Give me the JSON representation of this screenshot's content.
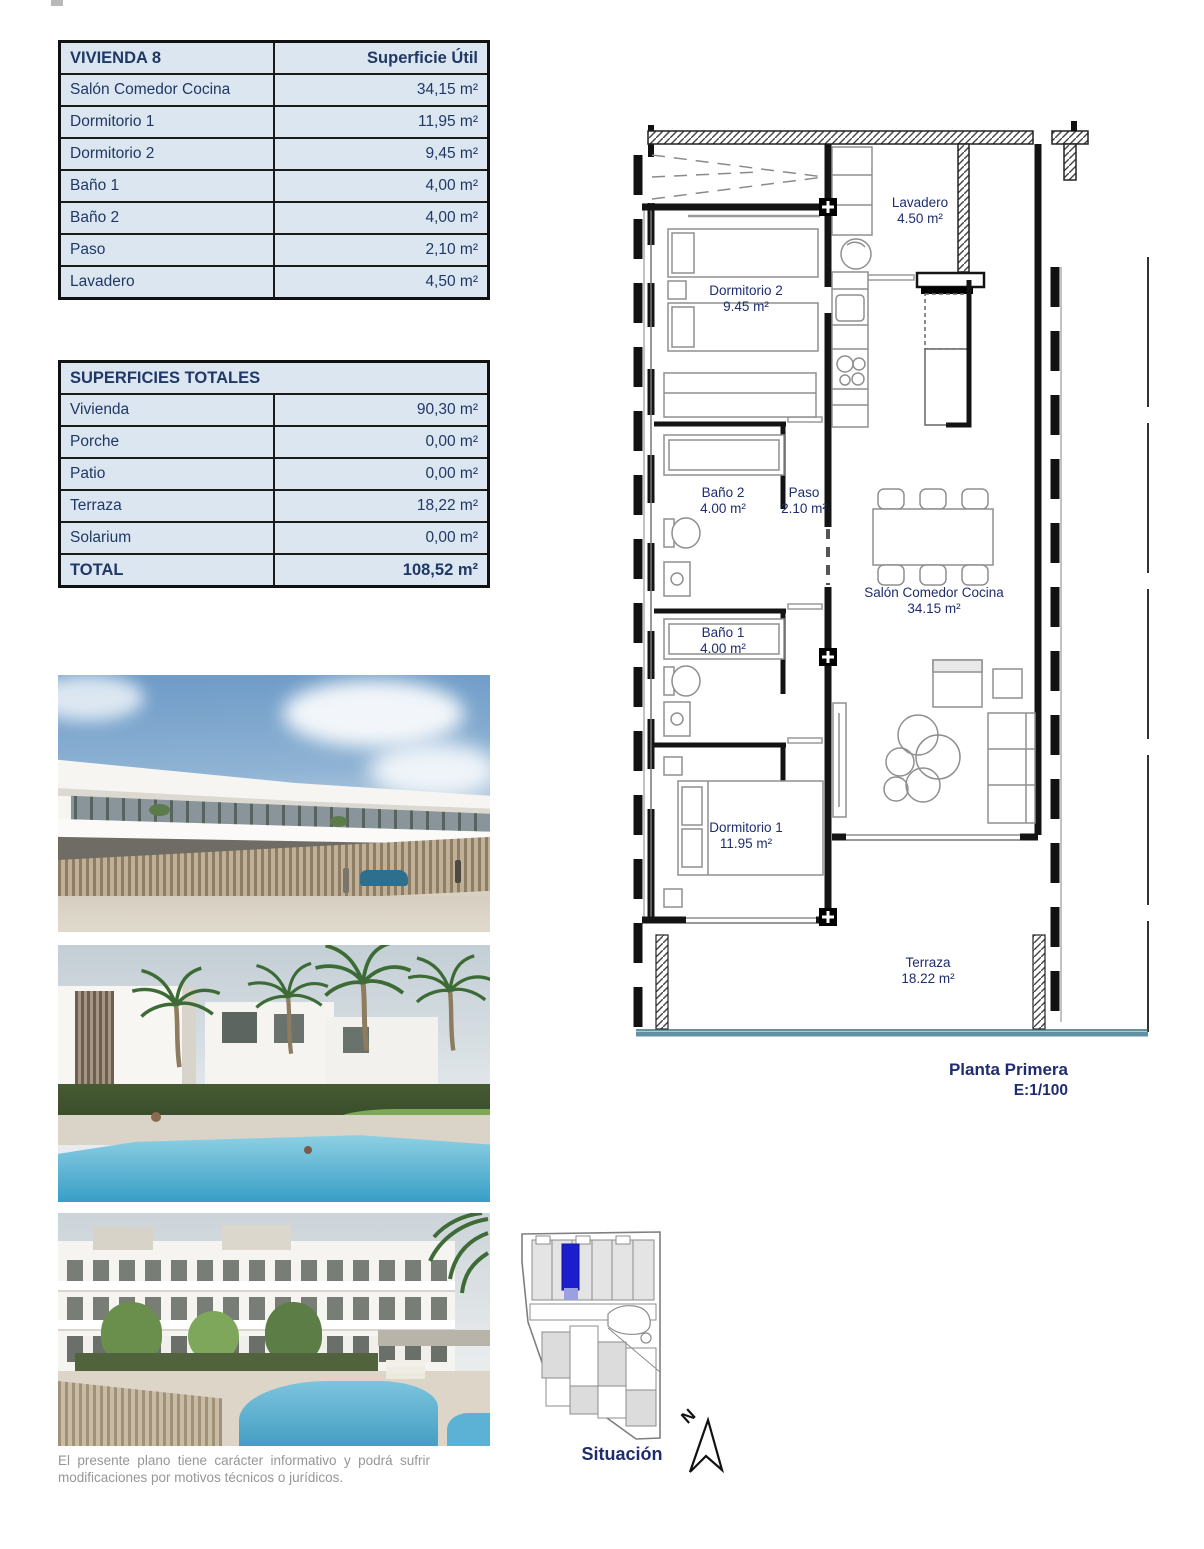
{
  "surface_table": {
    "title": "VIVIENDA 8",
    "header_right": "Superficie Útil",
    "rows": [
      {
        "label": "Salón Comedor Cocina",
        "value": "34,15 m²"
      },
      {
        "label": "Dormitorio 1",
        "value": "11,95 m²"
      },
      {
        "label": "Dormitorio 2",
        "value": "9,45 m²"
      },
      {
        "label": "Baño 1",
        "value": "4,00 m²"
      },
      {
        "label": "Baño 2",
        "value": "4,00 m²"
      },
      {
        "label": "Paso",
        "value": "2,10 m²"
      },
      {
        "label": "Lavadero",
        "value": "4,50 m²"
      }
    ]
  },
  "totals_table": {
    "title": "SUPERFICIES TOTALES",
    "rows": [
      {
        "label": "Vivienda",
        "value": "90,30 m²"
      },
      {
        "label": "Porche",
        "value": "0,00 m²"
      },
      {
        "label": "Patio",
        "value": "0,00 m²"
      },
      {
        "label": "Terraza",
        "value": "18,22 m²"
      },
      {
        "label": "Solarium",
        "value": "0,00 m²"
      }
    ],
    "total": {
      "label": "TOTAL",
      "value": "108,52 m²"
    }
  },
  "floor_plan": {
    "rooms": [
      {
        "name": "Lavadero",
        "area": "4.50 m²"
      },
      {
        "name": "Dormitorio 2",
        "area": "9.45 m²"
      },
      {
        "name": "Baño 2",
        "area": "4.00 m²"
      },
      {
        "name": "Paso",
        "area": "2.10 m²"
      },
      {
        "name": "Salón Comedor Cocina",
        "area": "34.15 m²"
      },
      {
        "name": "Baño 1",
        "area": "4.00 m²"
      },
      {
        "name": "Dormitorio 1",
        "area": "11.95 m²"
      },
      {
        "name": "Terraza",
        "area": "18.22 m²"
      }
    ],
    "caption": {
      "title": "Planta Primera",
      "scale": "E:1/100"
    }
  },
  "site_plan": {
    "label": "Situación",
    "north_label": "N"
  },
  "disclaimer": {
    "line1": "El presente plano tiene carácter informativo y podrá sufrir",
    "line2": "modificaciones por motivos técnicos o jurídicos."
  },
  "colors": {
    "table_fill": "#dce6f1",
    "navy_text": "#1f3864",
    "plan_label": "#1f2d6e",
    "terrace_rail": "#5f92a5",
    "site_highlight": "#1c1ecb",
    "disclaimer_gray": "#969696"
  }
}
